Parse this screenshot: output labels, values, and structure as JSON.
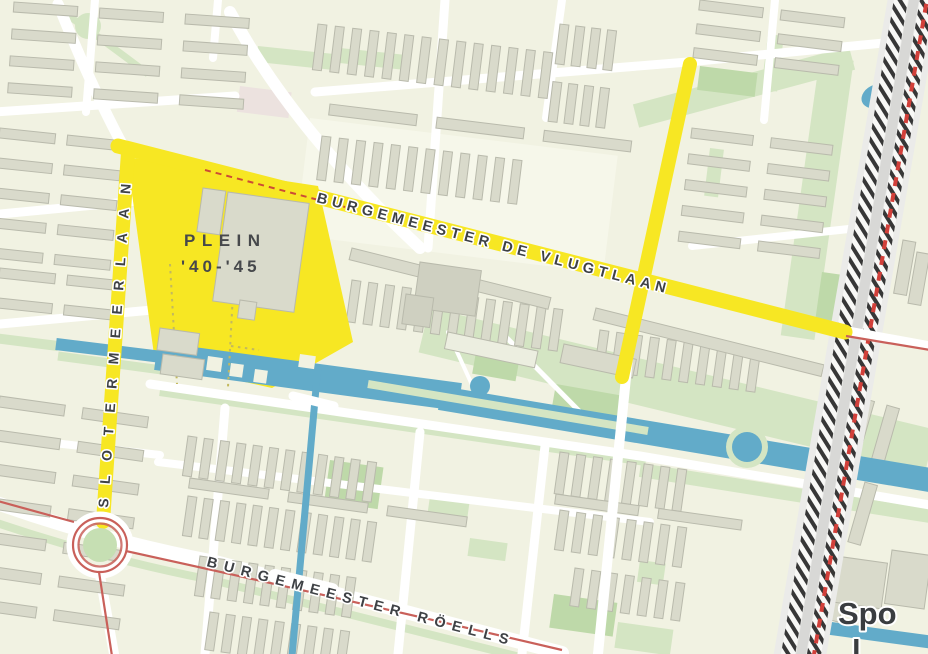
{
  "map": {
    "labels": {
      "place_line1": "PLEIN",
      "place_line2": "'40-'45",
      "street_diagonal": "BURGEMEESTER DE VLUGTLAAN",
      "street_vertical": "SLOTERMEERLAAN",
      "street_bottom": "BURGEMEESTER RÖELLS",
      "corner_partial_line1": "Spo",
      "corner_partial_line2": "l"
    },
    "colors": {
      "background": "#f1f2e2",
      "building_fill": "#d9dacb",
      "building_stroke": "#b9baac",
      "road": "#ffffff",
      "highlight": "#f7e723",
      "water": "#62abc9",
      "park_light": "#d4e5c3",
      "park_dark": "#bed9a9",
      "tram_red": "#c9605a",
      "rail_red": "#d2403a",
      "rail_dark": "#373737",
      "label_dark": "#46484b",
      "label_street": "#3e4145",
      "label_corner": "#3a3d40"
    }
  }
}
